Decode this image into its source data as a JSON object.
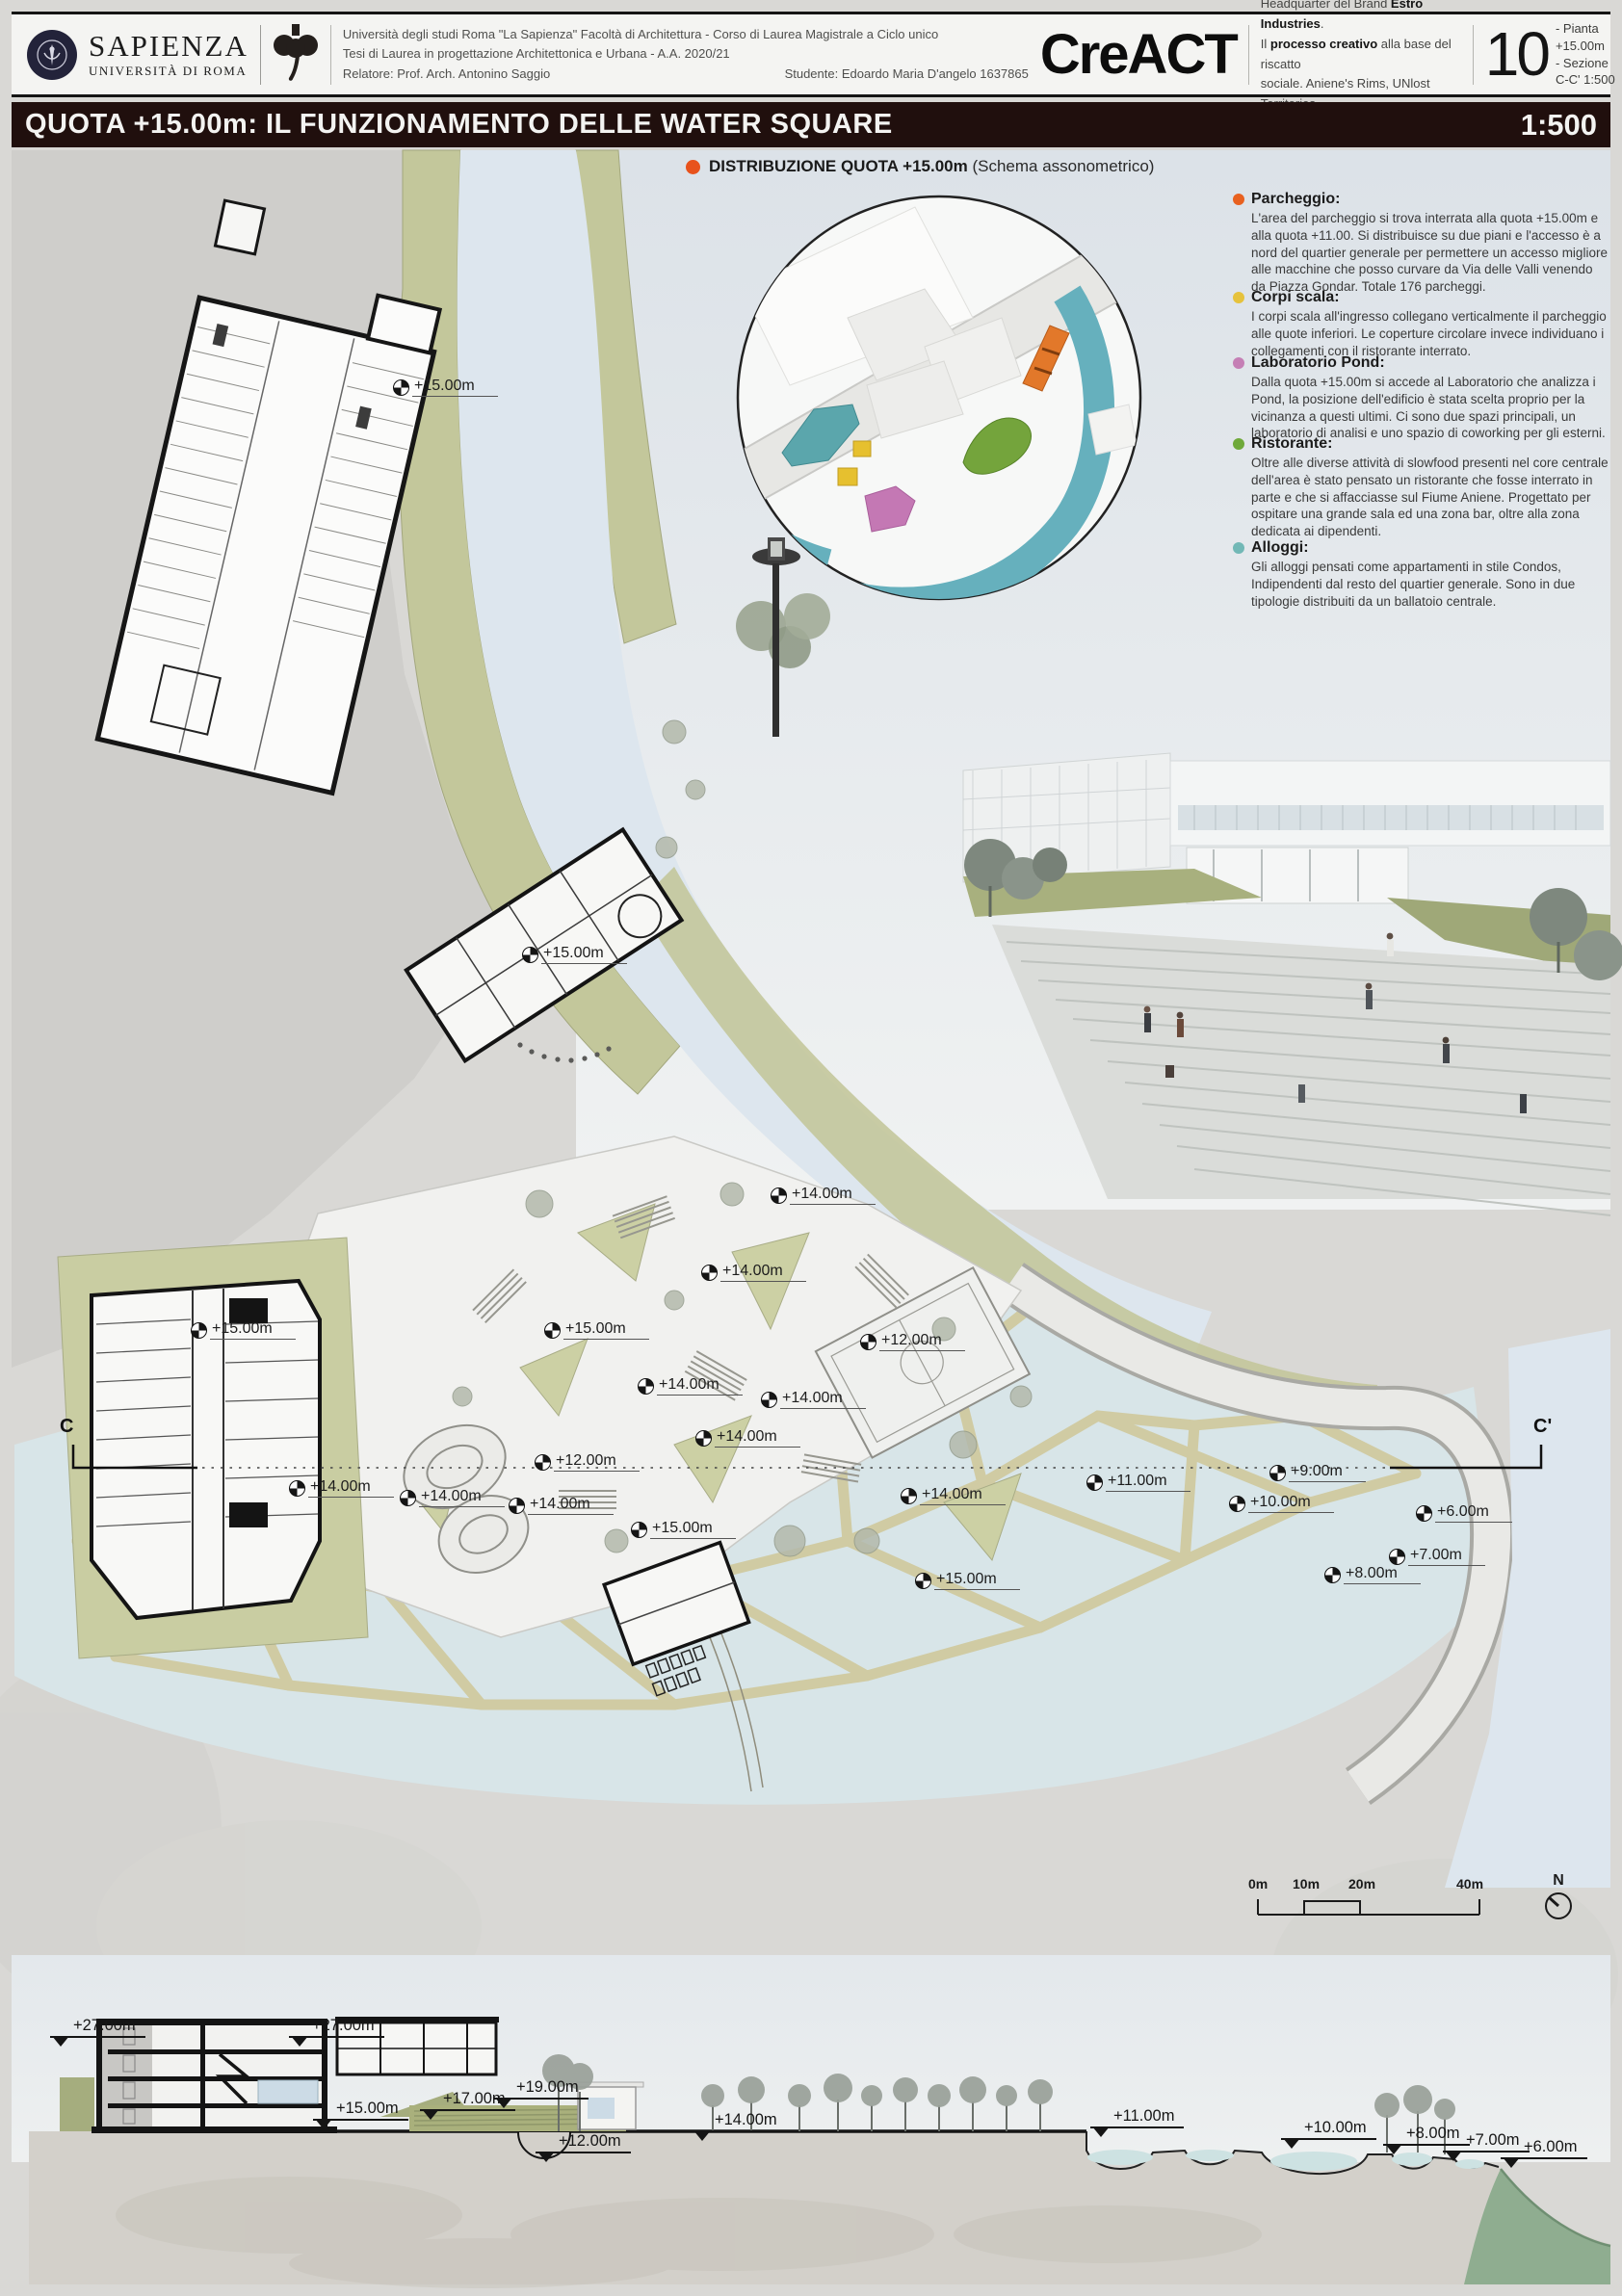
{
  "colors": {
    "titlebar_bg": "#200f0d",
    "schema_dot": "#e8521c",
    "water": "#dde6ee",
    "lake": "#d8e5e8",
    "olive_bank": "#c3c79b",
    "web_path": "#d0cba3",
    "ink": "#1c1c1c"
  },
  "header": {
    "sapienza_name": "SAPIENZA",
    "sapienza_sub": "UNIVERSITÀ DI ROMA",
    "line1": "Università degli studi Roma \"La Sapienza\" Facoltà di Architettura - Corso di Laurea Magistrale a Ciclo unico",
    "line2": "Tesi di Laurea in progettazione Architettonica e Urbana - A.A. 2020/21",
    "relatore": "Relatore: Prof. Arch. Antonino Saggio",
    "studente": "Studente: Edoardo Maria D'angelo 1637865",
    "brand": "CreACT",
    "desc1_pre": "Headquarter del  Brand ",
    "desc1_bold": "Estro Industries",
    "desc1_post": ".",
    "desc2_pre": "Il ",
    "desc2_bold": "processo creativo",
    "desc2_post": " alla base del  riscatto",
    "desc3": "sociale. Aniene's Rims, UNlost Territories.",
    "sheet_number": "10",
    "sheet_line1": "- Pianta",
    "sheet_line2": "+15.00m",
    "sheet_line3": "- Sezione",
    "sheet_line4": "C-C'  1:500"
  },
  "title_bar": {
    "title": "QUOTA +15.00m: IL FUNZIONAMENTO DELLE WATER SQUARE",
    "scale": "1:500"
  },
  "schema": {
    "label_bold": "DISTRIBUZIONE QUOTA +15.00m",
    "label_rest": " (Schema assonometrico)"
  },
  "legend": [
    {
      "title": "Parcheggio:",
      "color": "#e8611f",
      "text": "L'area del parcheggio si trova interrata alla quota +15.00m e alla quota +11.00. Si distribuisce su due piani e l'accesso è a nord del quartier generale per permettere un accesso migliore alle macchine che posso curvare da Via delle Valli venendo da Piazza Gondar. Totale 176 parcheggi."
    },
    {
      "title": "Corpi scala:",
      "color": "#e6c23c",
      "text": "I corpi scala all'ingresso  collegano verticalmente il parcheggio alle quote inferiori. Le coperture circolare invece individuano i collegamenti con il ristorante interrato."
    },
    {
      "title": "Laboratorio Pond:",
      "color": "#c57fb5",
      "text": "Dalla quota +15.00m si accede al Laboratorio che analizza i Pond, la posizione dell'edificio è stata scelta proprio per la vicinanza a questi ultimi. Ci sono due spazi principali, un laboratorio di analisi e uno spazio di coworking per gli esterni."
    },
    {
      "title": "Ristorante:",
      "color": "#6fa93a",
      "text": "Oltre alle diverse attività di slowfood presenti nel core centrale dell'area è stato pensato un ristorante che fosse interrato in parte e che si affacciasse sul Fiume Aniene. Progettato per ospitare una grande sala ed una zona bar, oltre alla zona dedicata ai dipendenti."
    },
    {
      "title": "Alloggi:",
      "color": "#72b8b6",
      "text": "Gli alloggi pensati come appartamenti in stile Condos, Indipendenti dal resto del quartier generale. Sono in due tipologie distribuiti da un ballatoio centrale."
    }
  ],
  "plan": {
    "section_line_start": "C",
    "section_line_end": "C'",
    "markers": [
      {
        "label": "+15.00m"
      },
      {
        "label": "+15.00m"
      },
      {
        "label": "+14.00m"
      },
      {
        "label": "+14.00m"
      },
      {
        "label": "+15.00m"
      },
      {
        "label": "+12.00m"
      },
      {
        "label": "+14.00m"
      },
      {
        "label": "+14.00m"
      },
      {
        "label": "+14.00m"
      },
      {
        "label": "+15.00m"
      },
      {
        "label": "+14.00m"
      },
      {
        "label": "+12.00m"
      },
      {
        "label": "+14.00m"
      },
      {
        "label": "+14.00m"
      },
      {
        "label": "+15.00m"
      },
      {
        "label": "+14.00m"
      },
      {
        "label": "+15.00m"
      },
      {
        "label": "+11.00m"
      },
      {
        "label": "+9.00m"
      },
      {
        "label": "+10.00m"
      },
      {
        "label": "+6.00m"
      },
      {
        "label": "+7.00m"
      },
      {
        "label": "+8.00m"
      }
    ]
  },
  "scalebar": {
    "l0": "0m",
    "l1": "10m",
    "l2": "20m",
    "l3": "40m",
    "north": "N"
  },
  "section": {
    "markers": [
      "+27.00m",
      "+27.00m",
      "+19.00m",
      "+17.00m",
      "+15.00m",
      "+12.00m",
      "+14.00m",
      "+11.00m",
      "+10.00m",
      "+8.00m",
      "+7.00m",
      "+6.00m"
    ]
  }
}
